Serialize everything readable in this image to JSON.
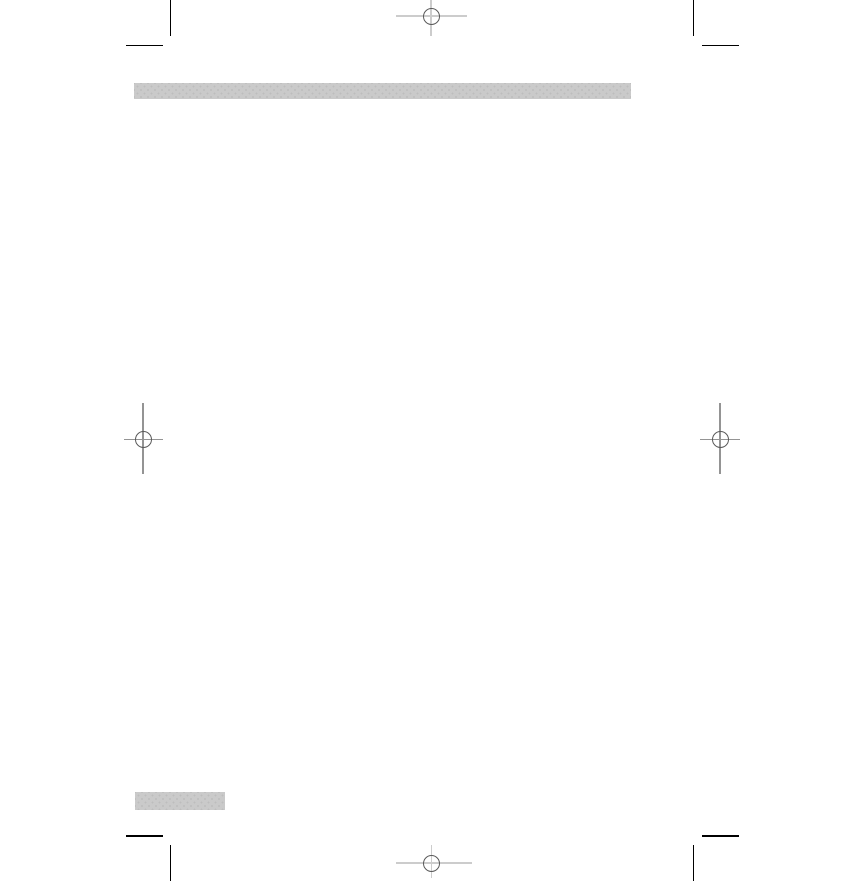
{
  "document": {
    "visible_text": "",
    "page_type_note": ""
  },
  "colors": {
    "page_background": "#ffffff",
    "crop_mark": "#000000",
    "registration_cross_center": "#cccccc",
    "registration_cross_side": "#949494",
    "registration_circle": "#5a5a5a",
    "bar_fill": "#cacaca",
    "bar_dot": "#bdbdbd"
  },
  "icons": {
    "registration_mark_top_center": "registration-mark-icon",
    "registration_mark_bottom_center": "registration-mark-icon",
    "registration_mark_middle_left": "registration-mark-icon",
    "registration_mark_middle_right": "registration-mark-icon",
    "crop_marks": "crop-mark-lines",
    "header_bar": "halftone-placeholder-bar",
    "footer_bar": "halftone-placeholder-bar"
  }
}
